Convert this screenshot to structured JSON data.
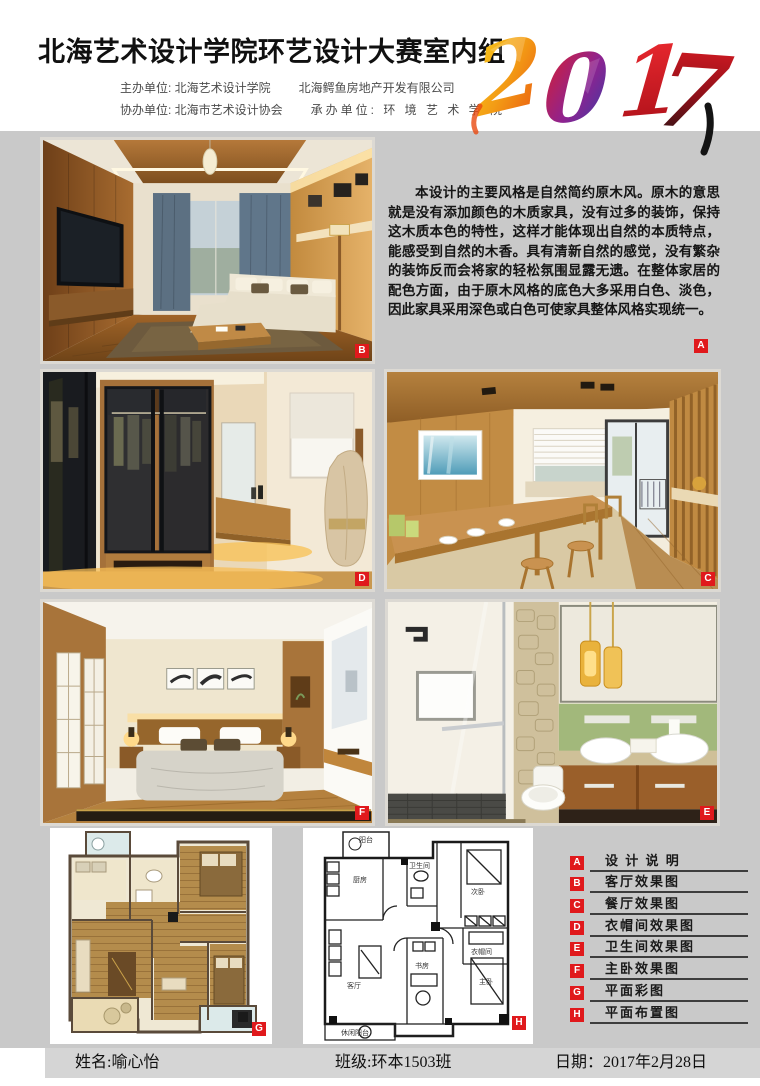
{
  "header": {
    "title": "北海艺术设计学院环艺设计大赛室内组",
    "year_digits": [
      "2",
      "0",
      "1",
      "7"
    ],
    "organizers": {
      "row1_left": "主办单位: 北海艺术设计学院",
      "row1_right": "北海鳄鱼房地产开发有限公司",
      "row2_left": "协办单位: 北海市艺术设计协会",
      "row2_right": "承办单位: 环 境 艺 术 学 院"
    }
  },
  "description": {
    "tag": "A",
    "text": "本设计的主要风格是自然简约原木风。原木的意思就是没有添加颜色的木质家具，没有过多的装饰，保持这木质本色的特性，这样才能体现出自然的本质特点，能感受到自然的木香。具有清新自然的感觉，没有繁杂的装饰反而会将家的轻松氛围显露无遗。在整体家居的配色方面，由于原木风格的底色大多采用白色、淡色，因此家具采用深色或白色可使家具整体风格实现统一。"
  },
  "photos": [
    {
      "tag": "B"
    },
    {
      "tag": "D"
    },
    {
      "tag": "C"
    },
    {
      "tag": "F"
    },
    {
      "tag": "E"
    },
    {
      "tag": "G"
    },
    {
      "tag": "H"
    }
  ],
  "legend": {
    "items": [
      {
        "letter": "A",
        "label": "设 计 说 明"
      },
      {
        "letter": "B",
        "label": "客厅效果图"
      },
      {
        "letter": "C",
        "label": "餐厅效果图"
      },
      {
        "letter": "D",
        "label": "衣帽间效果图"
      },
      {
        "letter": "E",
        "label": "卫生间效果图"
      },
      {
        "letter": "F",
        "label": "主卧效果图"
      },
      {
        "letter": "G",
        "label": "平面彩图"
      },
      {
        "letter": "H",
        "label": "平面布置图"
      }
    ]
  },
  "plan_h": {
    "labels": {
      "balcony": "阳台",
      "kitchen": "厨房",
      "bath": "卫生间",
      "bedroom2": "次卧",
      "cloak": "衣帽间",
      "living": "客厅",
      "study": "书房",
      "master": "主卧",
      "leisure": "休闲阳台"
    }
  },
  "footer": {
    "name": "姓名:喻心怡",
    "class": "班级:环本1503班",
    "date": "日期：2017年2月28日"
  },
  "colors": {
    "accent_red": "#e0191c",
    "canvas_gray": "#c9c9c9",
    "footer_gray": "#d5d5d5"
  }
}
